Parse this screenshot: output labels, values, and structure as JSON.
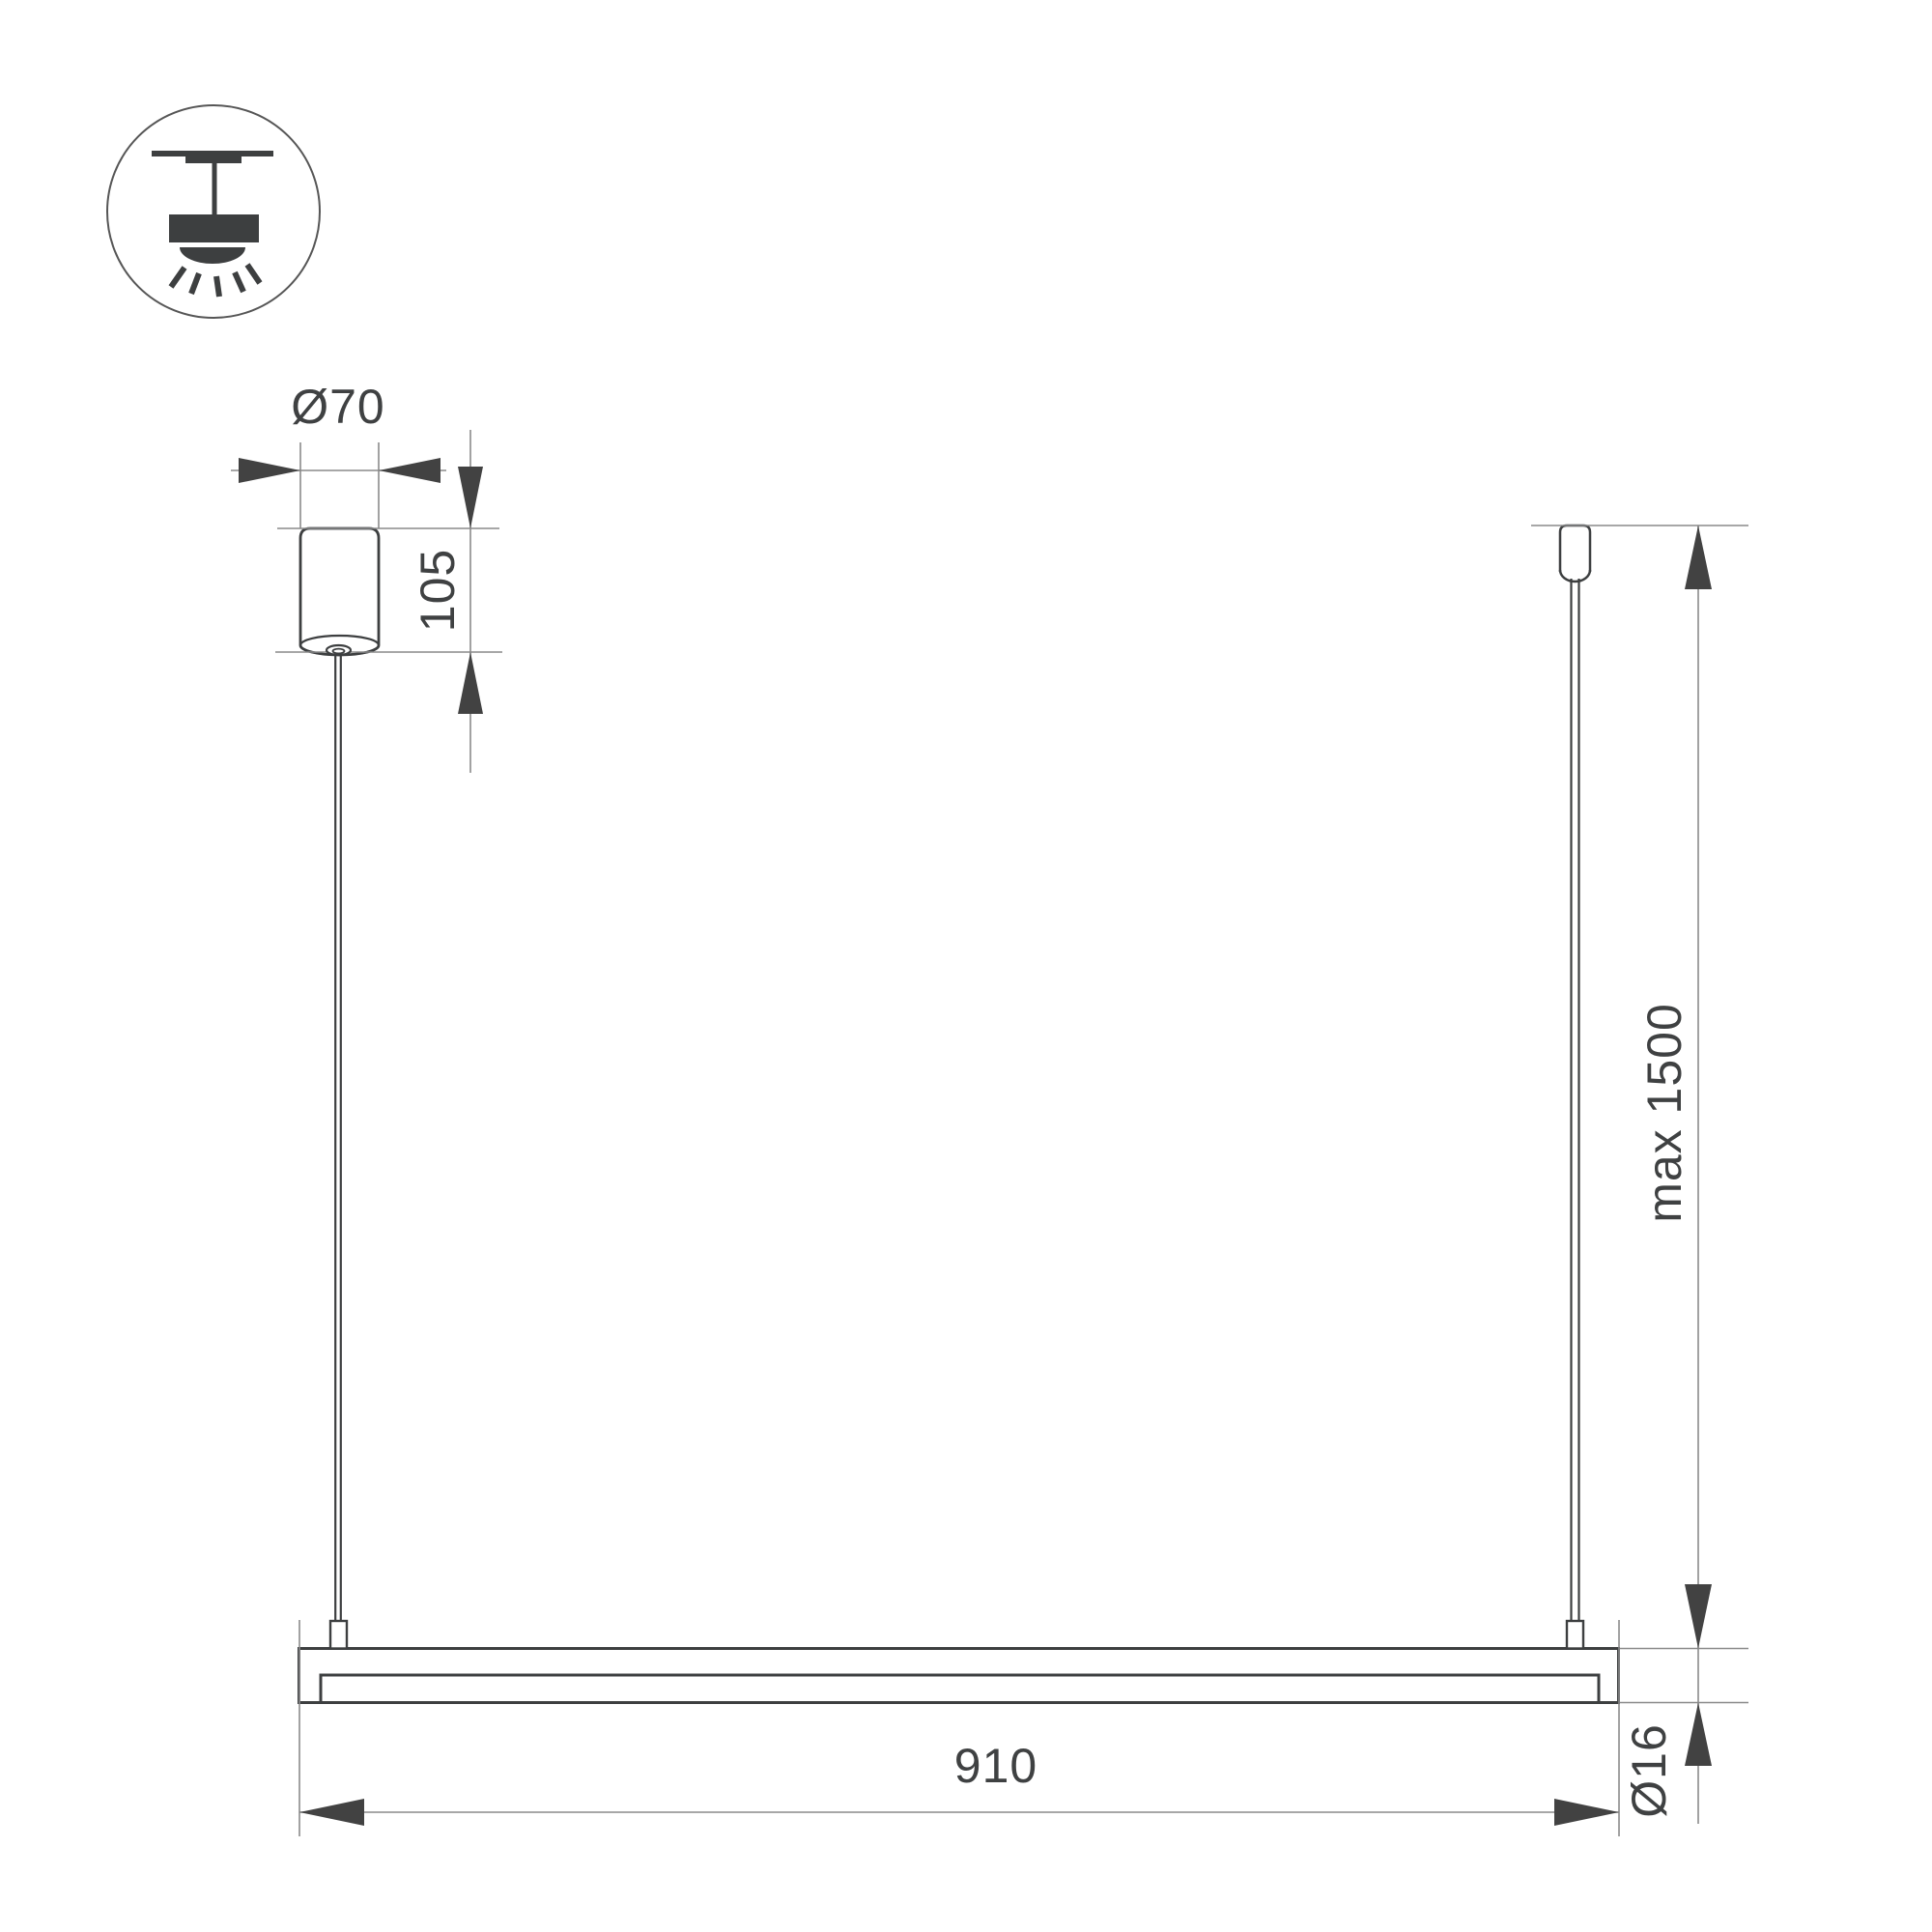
{
  "colors": {
    "background": "#ffffff",
    "ink": "#3d3f40",
    "thin_line": "#8a8a8a",
    "arrow": "#424242",
    "text": "#3f4142"
  },
  "legend": {
    "icon": "ceiling-pendant-light-icon"
  },
  "labels": {
    "canopy_diameter": "Ø70",
    "canopy_height": "105",
    "suspension_max_length": "max 1500",
    "fixture_length": "910",
    "profile_diameter": "Ø16"
  }
}
